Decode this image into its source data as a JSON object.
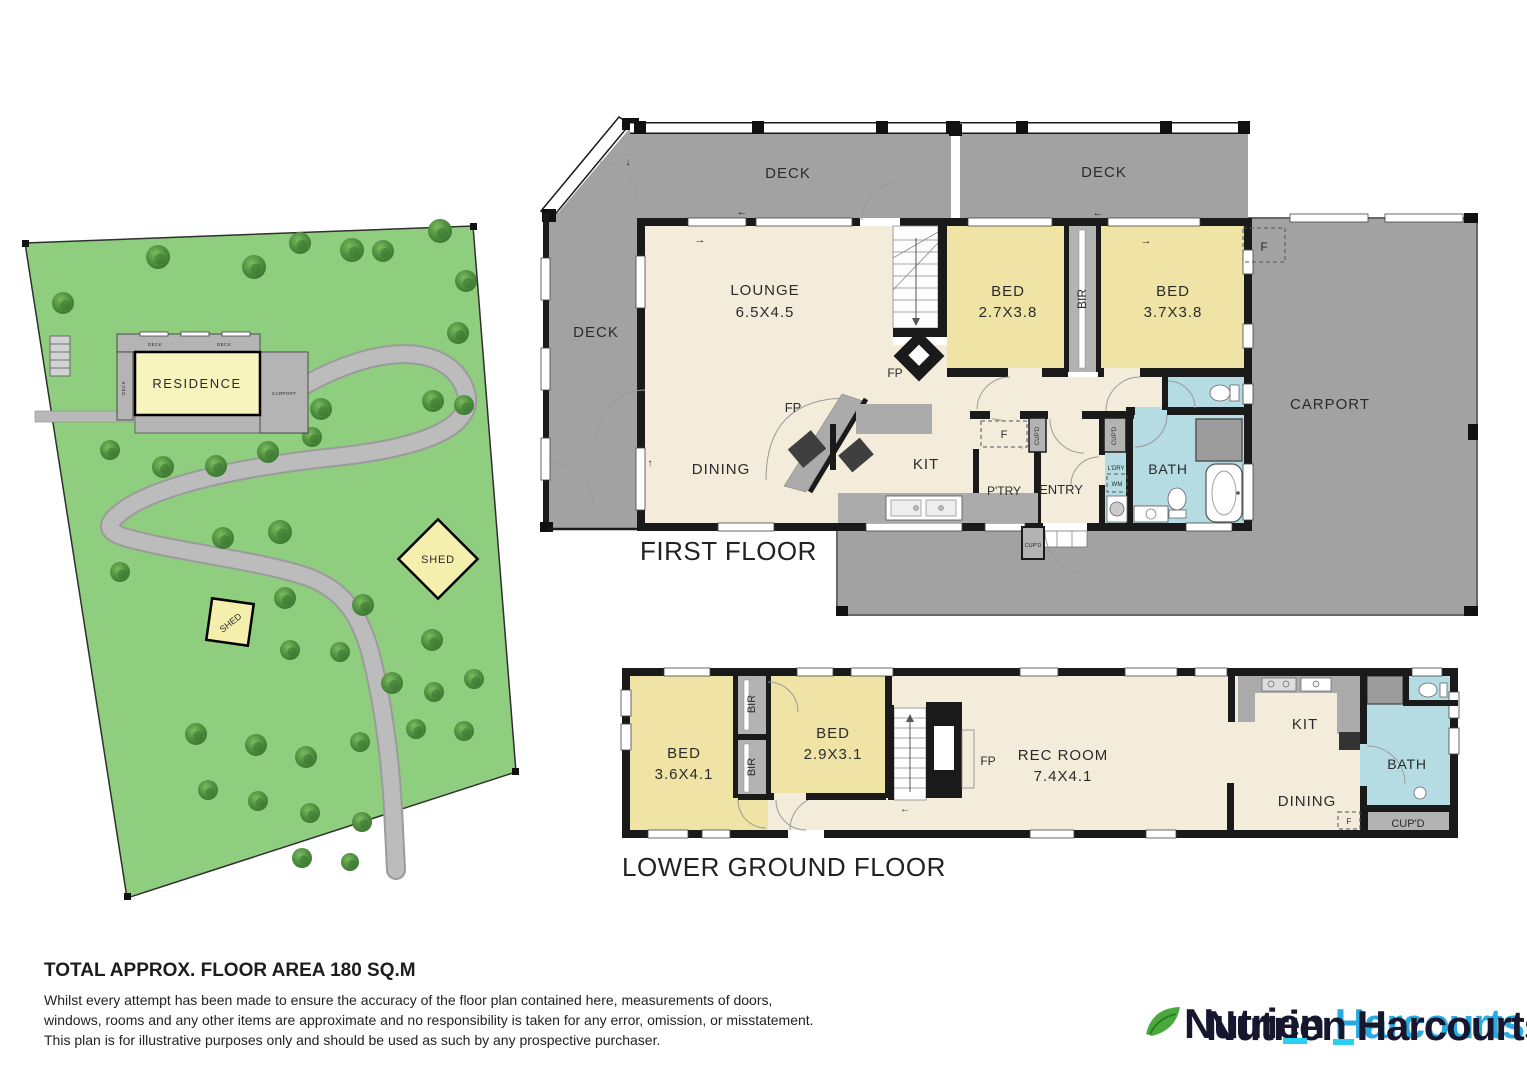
{
  "site": {
    "residence_label": "RESIDENCE",
    "carport_label": "CARPORT",
    "deck_top1": "DECK",
    "deck_top2": "DECK",
    "deck_side": "DECK",
    "shed1_label": "SHED",
    "shed2_label": "SHED",
    "land_color": "#8fce7e",
    "shed_color": "#f5efae",
    "trees": [
      [
        63,
        303,
        11
      ],
      [
        158,
        257,
        12
      ],
      [
        254,
        267,
        12
      ],
      [
        300,
        243,
        11
      ],
      [
        352,
        250,
        12
      ],
      [
        383,
        251,
        11
      ],
      [
        440,
        231,
        12
      ],
      [
        466,
        281,
        11
      ],
      [
        458,
        333,
        11
      ],
      [
        433,
        401,
        11
      ],
      [
        464,
        405,
        10
      ],
      [
        160,
        420,
        12
      ],
      [
        216,
        421,
        12
      ],
      [
        277,
        402,
        11
      ],
      [
        321,
        409,
        11
      ],
      [
        312,
        437,
        10
      ],
      [
        110,
        450,
        10
      ],
      [
        163,
        467,
        11
      ],
      [
        216,
        466,
        11
      ],
      [
        268,
        452,
        11
      ],
      [
        120,
        572,
        10
      ],
      [
        223,
        538,
        11
      ],
      [
        280,
        532,
        12
      ],
      [
        285,
        598,
        11
      ],
      [
        363,
        605,
        11
      ],
      [
        432,
        640,
        11
      ],
      [
        290,
        650,
        10
      ],
      [
        340,
        652,
        10
      ],
      [
        392,
        683,
        11
      ],
      [
        434,
        692,
        10
      ],
      [
        474,
        679,
        10
      ],
      [
        196,
        734,
        11
      ],
      [
        256,
        745,
        11
      ],
      [
        306,
        757,
        11
      ],
      [
        360,
        742,
        10
      ],
      [
        416,
        729,
        10
      ],
      [
        464,
        731,
        10
      ],
      [
        208,
        790,
        10
      ],
      [
        258,
        801,
        10
      ],
      [
        310,
        813,
        10
      ],
      [
        362,
        822,
        10
      ],
      [
        302,
        858,
        10
      ],
      [
        350,
        862,
        9
      ]
    ]
  },
  "first_floor": {
    "title": "FIRST FLOOR",
    "deck_top1": "DECK",
    "deck_top2": "DECK",
    "deck_side": "DECK",
    "lounge_name": "LOUNGE",
    "lounge_size": "6.5X4.5",
    "bed1_name": "BED",
    "bed1_size": "2.7X3.8",
    "bed2_name": "BED",
    "bed2_size": "3.7X3.8",
    "bir": "BIR",
    "carport": "CARPORT",
    "dining": "DINING",
    "kitchen": "KIT",
    "pantry": "P'TRY",
    "entry": "ENTRY",
    "bath": "BATH",
    "laundry": "L'DRY",
    "wm": "WM",
    "cupboard": "CUP'D",
    "fridge": "F",
    "fireplace": "FP"
  },
  "lower_floor": {
    "title": "LOWER GROUND FLOOR",
    "bed1_name": "BED",
    "bed1_size": "3.6X4.1",
    "bed2_name": "BED",
    "bed2_size": "2.9X3.1",
    "rec_name": "REC ROOM",
    "rec_size": "7.4X4.1",
    "bir": "BIR",
    "kitchen": "KIT",
    "dining": "DINING",
    "bath": "BATH",
    "cupboard": "CUP'D",
    "fridge": "F",
    "fireplace": "FP"
  },
  "arrows": {
    "left": "←",
    "right": "→",
    "up": "↑",
    "down": "↓"
  },
  "footer": {
    "area_title": "TOTAL APPROX. FLOOR AREA 180 SQ.M",
    "disclaimer_lines": [
      "Whilst every attempt has been made to ensure the accuracy of the floor plan contained here, measurements of doors,",
      "windows, rooms and any other items are approximate and no responsibility is taken for any error, omission, or misstatement.",
      "This plan is for illustrative purposes only and should be used as such by any prospective purchaser."
    ]
  },
  "logo": {
    "brand_primary": "Nutrien",
    "brand_secondary": "Harcourts",
    "leaf_color": "#4aa93c",
    "blue": "#29abe2",
    "dark": "#16162e"
  }
}
